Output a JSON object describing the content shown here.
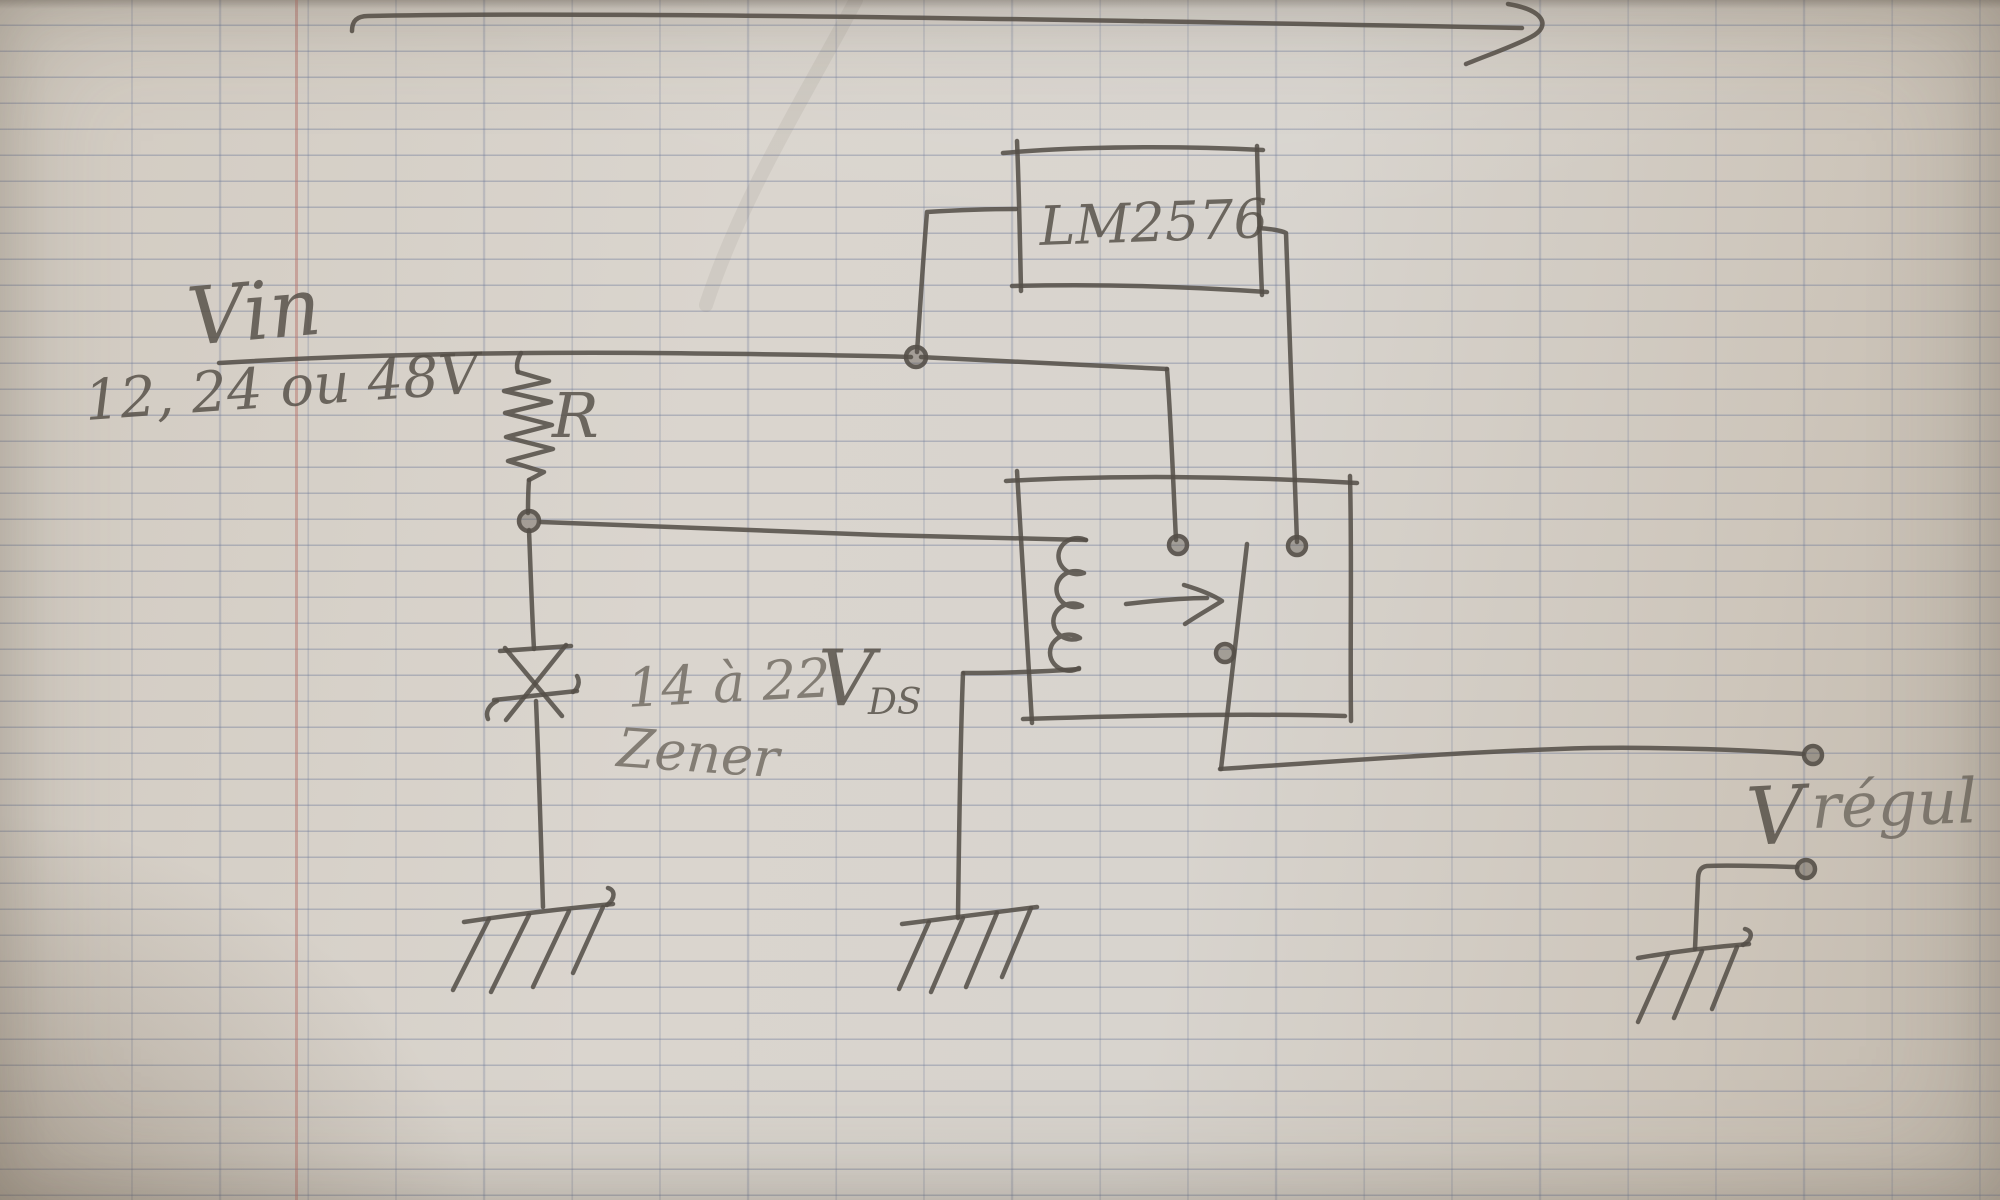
{
  "photo": {
    "description": "Pencil hand-drawn switching regulator schematic on squared notebook paper",
    "language": "French"
  },
  "labels": {
    "vin": "Vin",
    "vin_range": "12, 24 ou 48V",
    "resistor": "R",
    "ic": "LM2576",
    "zener_range": "14 à 22",
    "zener_v": "V",
    "zener_v_sub": "DS",
    "zener_name": "Zener",
    "vout_v": "V",
    "vout_name": "régul"
  },
  "components": [
    {
      "name": "input-rail",
      "label": "Vin 12, 24 ou 48V"
    },
    {
      "name": "series-resistor",
      "label": "R"
    },
    {
      "name": "zener-diode",
      "label": "Zener 14 à 22 V DS"
    },
    {
      "name": "regulator-ic",
      "label": "LM2576"
    },
    {
      "name": "pass-transistor",
      "label": ""
    },
    {
      "name": "output-terminal",
      "label": "V régul"
    },
    {
      "name": "ground-symbols",
      "count": 3
    }
  ],
  "colors": {
    "paper": "#d5cec5",
    "grid_line": "#687596",
    "margin_line": "#b8766e",
    "pencil": "#554f48"
  }
}
